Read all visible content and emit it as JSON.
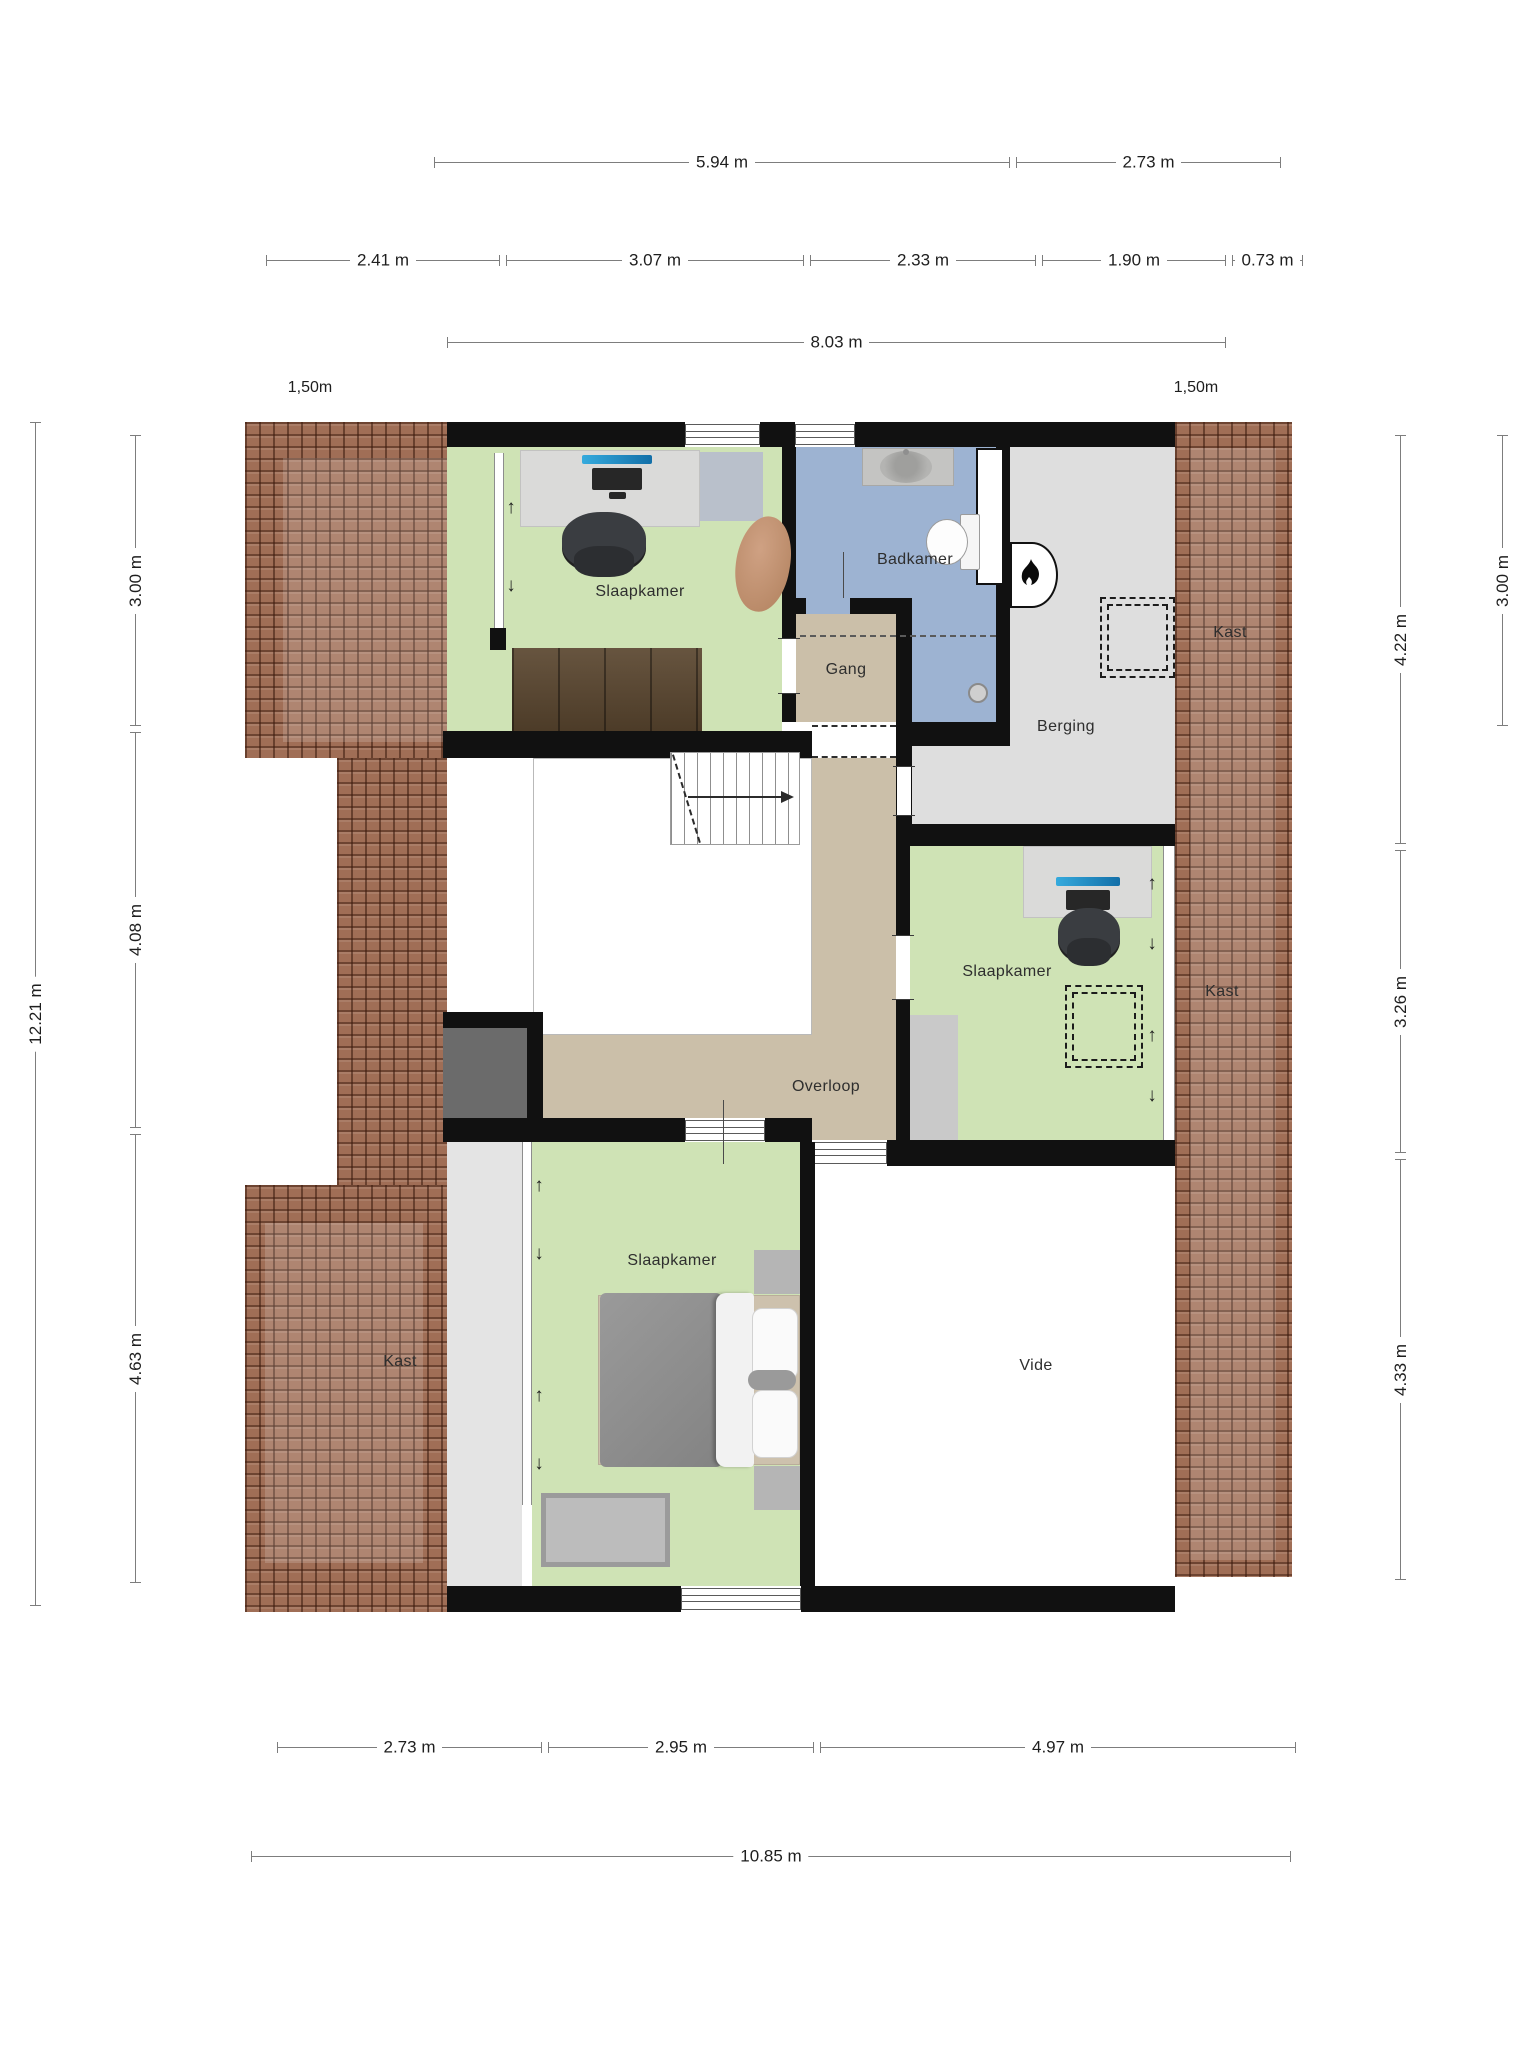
{
  "rooms": {
    "slaapkamer_tl": "Slaapkamer",
    "badkamer": "Badkamer",
    "gang": "Gang",
    "berging": "Berging",
    "kast_top_right": "Kast",
    "slaapkamer_mid": "Slaapkamer",
    "kast_mid_right": "Kast",
    "overloop": "Overloop",
    "kast_bottom_left": "Kast",
    "slaapkamer_bottom": "Slaapkamer",
    "vide": "Vide"
  },
  "dimensions": {
    "top_row1": [
      {
        "label": "5.94 m"
      },
      {
        "label": "2.73 m"
      }
    ],
    "top_row2": [
      {
        "label": "2.41 m"
      },
      {
        "label": "3.07 m"
      },
      {
        "label": "2.33 m"
      },
      {
        "label": "1.90 m"
      },
      {
        "label": "0.73 m"
      }
    ],
    "top_row3": [
      {
        "label": "8.03 m"
      }
    ],
    "bottom_row1": [
      {
        "label": "2.73 m"
      },
      {
        "label": "2.95 m"
      },
      {
        "label": "4.97 m"
      }
    ],
    "bottom_row2": [
      {
        "label": "10.85 m"
      }
    ],
    "left_outer": {
      "label": "12.21 m"
    },
    "left_inner": [
      {
        "label": "3.00 m"
      },
      {
        "label": "4.08 m"
      },
      {
        "label": "4.63 m"
      }
    ],
    "right_inner": [
      {
        "label": "4.22 m"
      },
      {
        "label": "3.26 m"
      },
      {
        "label": "4.33 m"
      }
    ],
    "right_outer": {
      "label": "3.00 m"
    }
  },
  "roof_offsets": {
    "left": "1,50m",
    "right": "1,50m"
  },
  "icons": {
    "slope_up": "↑",
    "slope_down": "↓"
  },
  "colors": {
    "roof": "#a06e56",
    "bedroom_green": "#cfe3b5",
    "bathroom_blue": "#9db3d2",
    "hall_tan": "#cbbfa9",
    "storage_gray": "#dedede",
    "closet_floor": "#e4e4e4",
    "wall": "#111111"
  }
}
